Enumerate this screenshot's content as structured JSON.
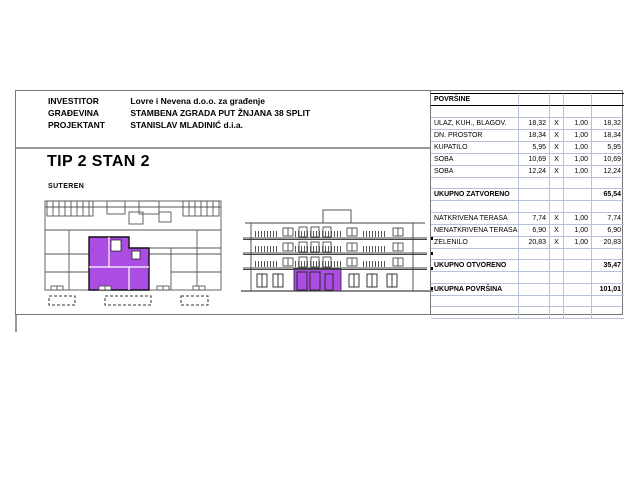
{
  "header": {
    "rows": [
      {
        "label": "INVESTITOR",
        "value": "Lovre i Nevena d.o.o. za građenje"
      },
      {
        "label": "GRAĐEVINA",
        "value": "STAMBENA ZGRADA PUT ŽNJANA 38 SPLIT"
      },
      {
        "label": "PROJEKTANT",
        "value": "STANISLAV MLADINIĆ d.i.a."
      }
    ]
  },
  "plan": {
    "title": "TIP 2 STAN 2",
    "subtitle": "SUTEREN",
    "highlight_color": "#ab4de3"
  },
  "areas_table": {
    "title": "POVRŠINE",
    "rows": [
      {
        "label": "ULAZ, KUH., BLAGOV.",
        "value": "18,32",
        "op": "X",
        "factor": "1,00",
        "total": "18,32"
      },
      {
        "label": "DN. PROSTOR",
        "value": "18,34",
        "op": "X",
        "factor": "1,00",
        "total": "18,34"
      },
      {
        "label": "KUPATILO",
        "value": "5,95",
        "op": "X",
        "factor": "1,00",
        "total": "5,95"
      },
      {
        "label": "SOBA",
        "value": "10,69",
        "op": "X",
        "factor": "1,00",
        "total": "10,69"
      },
      {
        "label": "SOBA",
        "value": "12,24",
        "op": "X",
        "factor": "1,00",
        "total": "12,24"
      },
      {
        "label": "UKUPNO ZATVORENO",
        "total": "65,54"
      },
      {
        "label": "NATKRIVENA TERASA",
        "value": "7,74",
        "op": "X",
        "factor": "1,00",
        "total": "7,74"
      },
      {
        "label": "NENATKRIVENA TERASA",
        "value": "6,90",
        "op": "X",
        "factor": "1,00",
        "total": "6,90"
      },
      {
        "label": "ZELENILO",
        "value": "20,83",
        "op": "X",
        "factor": "1,00",
        "total": "20,83"
      },
      {
        "label": "UKUPNO OTVORENO",
        "total": "35,47"
      },
      {
        "label": "UKUPNA POVRŠINA",
        "total": "101,01"
      }
    ]
  }
}
